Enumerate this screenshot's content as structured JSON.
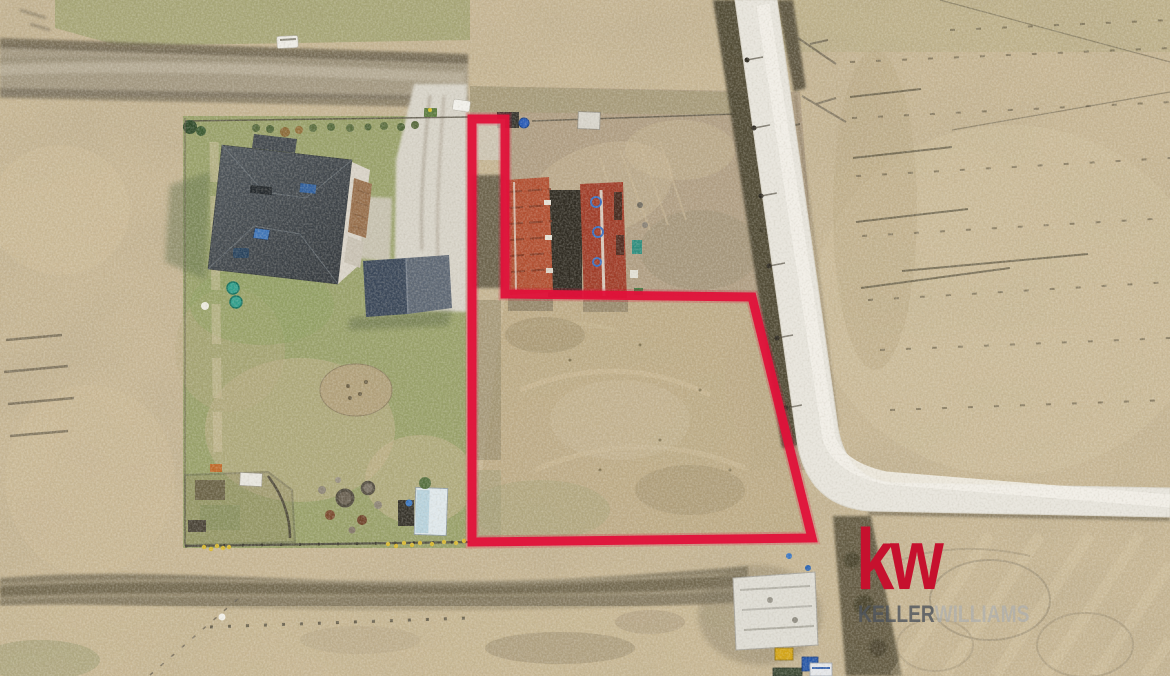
{
  "scene": {
    "type": "aerial-drone-photo",
    "subject": "Vacant flag-shaped land parcel outlined in red, beside a white gravel road, next to a residential property with a dark-roofed house, garage shed and two red-roofed farm buildings, surrounded by dry tan fields"
  },
  "watermark": {
    "logo_mark": "kw",
    "brand_primary": "KELLER",
    "brand_secondary": "WILLIAMS"
  },
  "colors": {
    "plot_outline": "#e0123a",
    "logo_red": "#c6112e",
    "brand_primary_gray": "#50565f",
    "brand_secondary_gray": "#a8aeb4"
  }
}
